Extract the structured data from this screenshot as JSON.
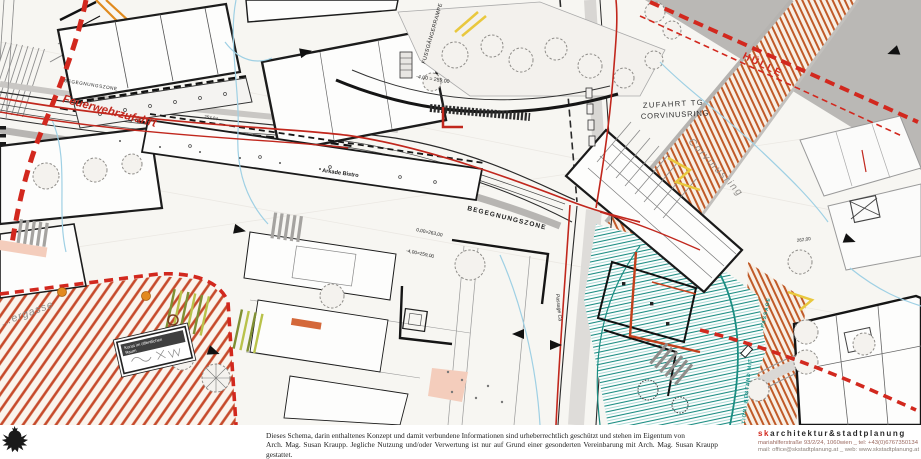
{
  "plan_labels": {
    "feuerwehrzufahrt": "Feuerwehrzufahrt",
    "begegnungszone_west": "BEGEGNUNGSZONE",
    "begegnungszone_mitte": "BEGEGNUNGSZONE",
    "fussgaengerrampe": "FUSSGÄNGERRAMPE",
    "arkade_bistro": "Arkade Bistro",
    "zufahrt_tg_line1": "ZUFAHRT TG",
    "zufahrt_tg_line2": "CORVINUSRING",
    "huelle": "HÜLLE",
    "corvinusring": "Corvinusring",
    "ergasse": "…ergasse",
    "passage_ca": "Passage Ca",
    "bestand_teal": "TION: BESTAND MIT",
    "passage_teal": "PASSAGE",
    "kunst_line1": "Kunst im öffentlichen",
    "kunst_line2": "Raum"
  },
  "elevations": {
    "ramp_top": "-4,00 = 259,00",
    "zone_zero": "0,00=263,00",
    "zone_minus4": "-4,00=259,00",
    "street_west": "253,04",
    "east": "262,00"
  },
  "footer": {
    "disclaimer_line1": "Dieses Schema, darin enthaltenes Konzept und damit verbundene Informationen sind urheberrechtlich geschützt und stehen im Eigentum von",
    "disclaimer_line2": "Arch. Mag. Susan Kraupp. Jegliche Nutzung und/oder Verwertung ist nur auf Grund einer gesonderten Vereinbarung mit  Arch. Mag. Susan Kraupp gestattet.",
    "brand_sk": "sk",
    "brand_rest": "architektur&stadtplanung",
    "address_line": "mariahilferstraße 93/2/24, 1060wien _ tel: +43(0)6767350134",
    "contact_line": "mail: office@skstadtplanung.at _ web: www.skstadtplanung.at"
  },
  "colors": {
    "boundary_red": "#d2281e",
    "route_red": "#c1271d",
    "hatch_orange": "#c05a28",
    "hatch_red": "#c64a2b",
    "teal": "#1b8d82",
    "cyan_utility": "#9fd0e4",
    "gray_area": "#bab8b5",
    "parking_green": "#7f8f33",
    "marking_yellow": "#e9c83e",
    "tree_orange": "#e2891f",
    "brand_red": "#d2281e"
  }
}
